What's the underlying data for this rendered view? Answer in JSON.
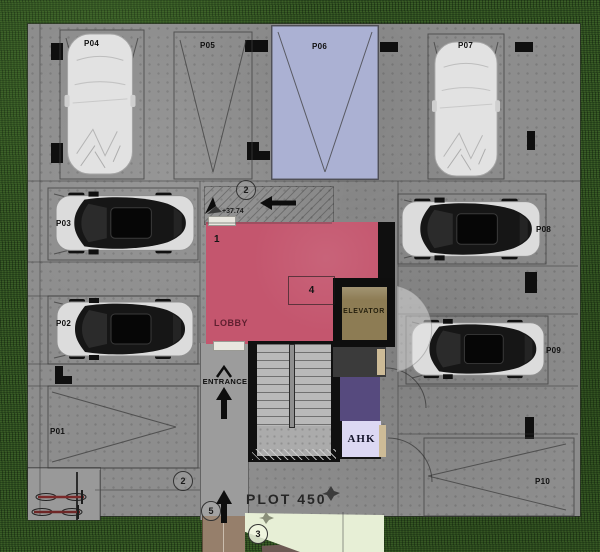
{
  "site": {
    "plot_label": "PLOT 450",
    "elevation": "+37.74",
    "entrance_label": "ENTRANCE"
  },
  "rooms": {
    "lobby_label": "LOBBY",
    "elevator_label": "ELEVATOR",
    "ahk_label": "AHK"
  },
  "markers": {
    "one": "1",
    "two_top": "2",
    "two_bottom": "2",
    "three": "3",
    "four": "4",
    "five": "5"
  },
  "spots": [
    {
      "id": "P01",
      "label": "P01",
      "status": "empty"
    },
    {
      "id": "P02",
      "label": "P02",
      "status": "car-parked"
    },
    {
      "id": "P03",
      "label": "P03",
      "status": "car-parked"
    },
    {
      "id": "P04",
      "label": "P04",
      "status": "covered-car"
    },
    {
      "id": "P05",
      "label": "P05",
      "status": "empty"
    },
    {
      "id": "P06",
      "label": "P06",
      "status": "highlighted-empty"
    },
    {
      "id": "P07",
      "label": "P07",
      "status": "covered-car"
    },
    {
      "id": "P08",
      "label": "P08",
      "status": "car-parked"
    },
    {
      "id": "P09",
      "label": "P09",
      "status": "car-parked"
    },
    {
      "id": "P10",
      "label": "P10",
      "status": "empty"
    }
  ],
  "colors": {
    "grass": "#2b4a1e",
    "concrete": "#8d8d8d",
    "highlighted_spot": "#abb1d3",
    "lobby": "#c4566e",
    "elevator": "#8d7c54",
    "service_purple": "#564a7e",
    "ahk_room": "#dcd8f3",
    "lawn_patch": "#e7efd6",
    "entry_path": "#967f6b"
  }
}
